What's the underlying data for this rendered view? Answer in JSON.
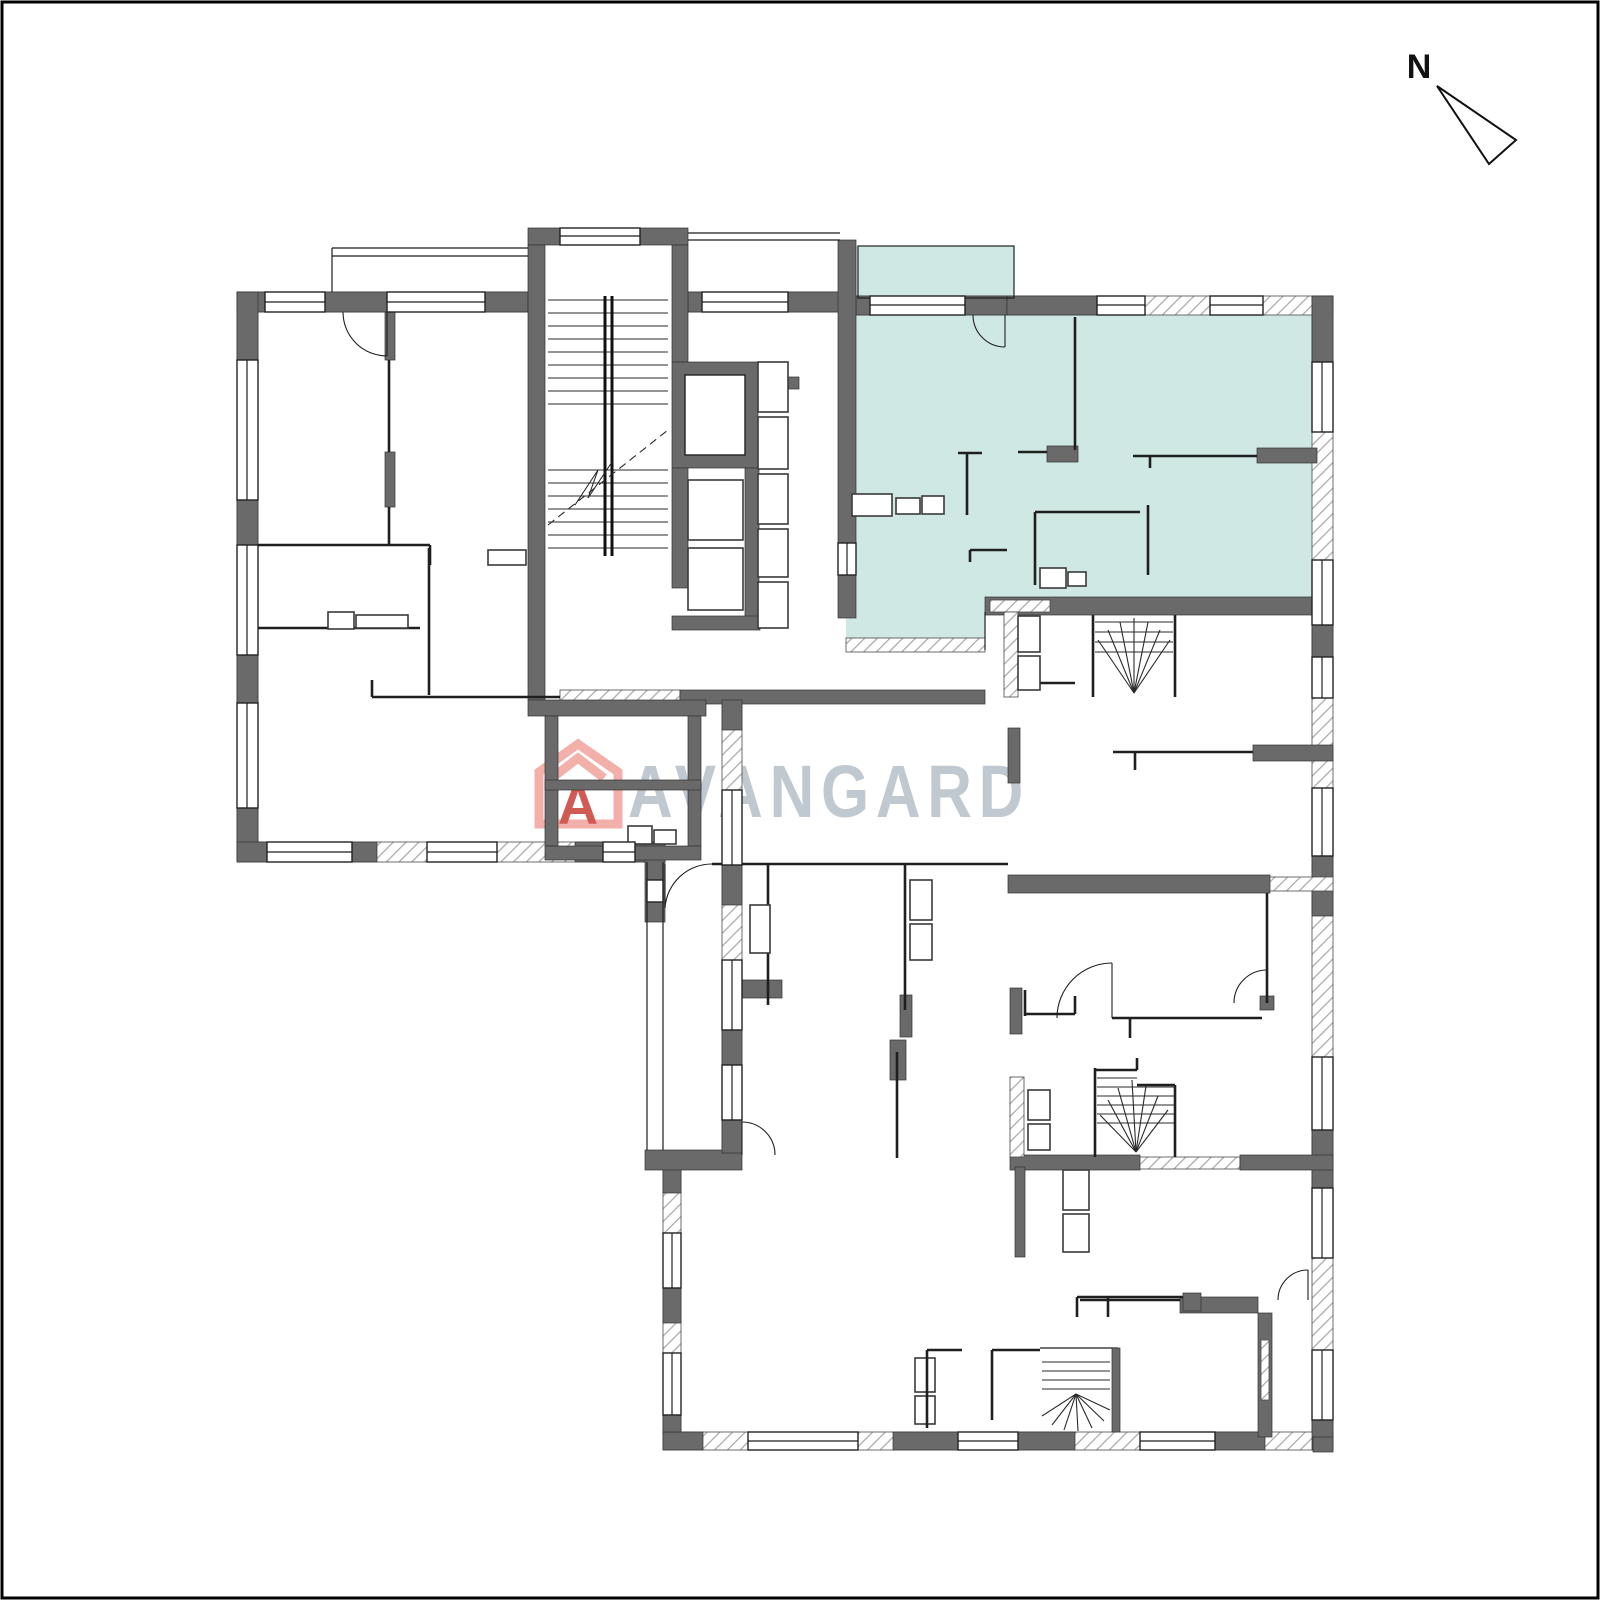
{
  "compass": {
    "label": "N"
  },
  "watermark": {
    "logo_letter": "A",
    "brand": "AVANGARD"
  },
  "plan": {
    "kind": "residential floor plan",
    "highlighted_unit_fill": "teal"
  },
  "colors": {
    "highlight": "#cfe8e4",
    "wall": "#6a6a6a",
    "hatch_line": "#a9a9a9",
    "line": "#1f1f1f",
    "logo_outline": "#f2a7a0",
    "logo_letter": "#cb4a42",
    "watermark_text": "#b5bec6",
    "page_border": "#000000"
  }
}
